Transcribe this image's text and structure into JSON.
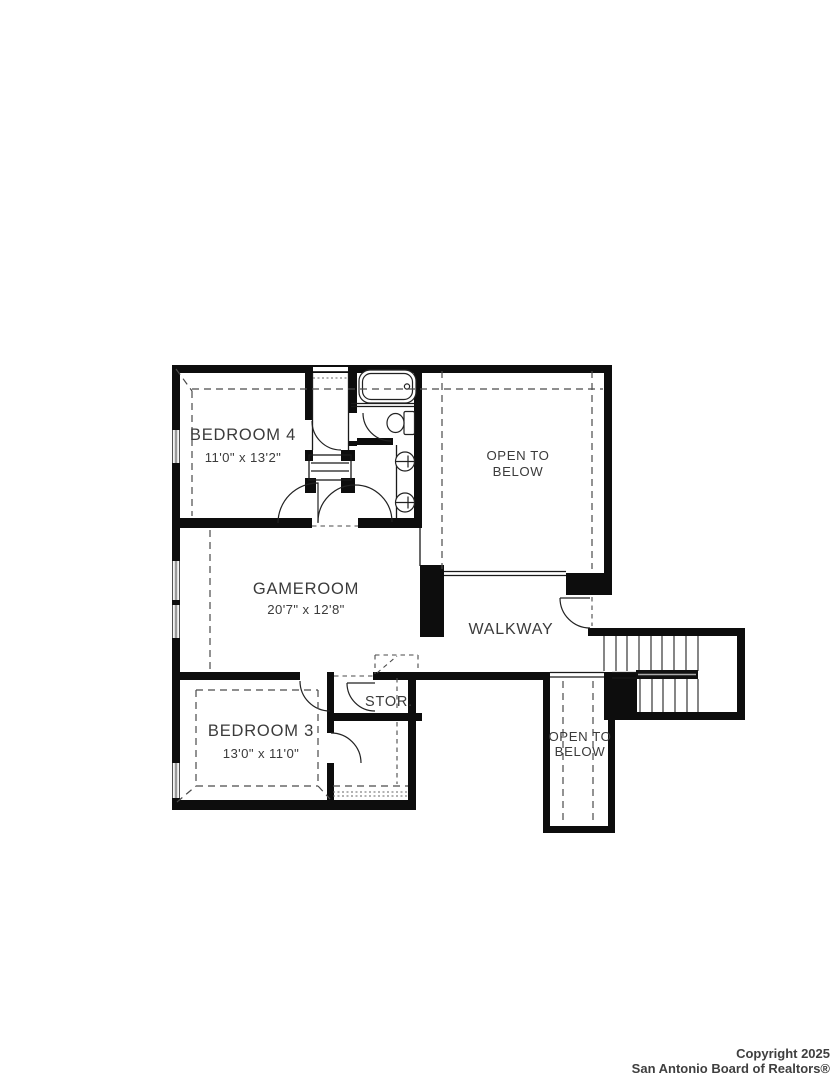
{
  "plan": {
    "type": "floorplan",
    "colors": {
      "wall": "#0d0d0d",
      "label": "#3b3b3b",
      "window": "#9a9a9a"
    },
    "rooms": {
      "bedroom4": {
        "name": "BEDROOM 4",
        "dims": "11'0\" x 13'2\""
      },
      "gameroom": {
        "name": "GAMEROOM",
        "dims": "20'7\" x 12'8\""
      },
      "bedroom3": {
        "name": "BEDROOM 3",
        "dims": "13'0\" x 11'0\""
      },
      "walkway": {
        "name": "WALKWAY"
      },
      "storage": {
        "name": "STOR."
      },
      "open_to_below_upper": {
        "line1": "OPEN TO",
        "line2": "BELOW"
      },
      "open_to_below_lower": {
        "line1": "OPEN TO",
        "line2": "BELOW"
      }
    }
  },
  "footer": {
    "copyright_line1": "Copyright 2025",
    "copyright_line2": "San Antonio Board of Realtors®"
  }
}
